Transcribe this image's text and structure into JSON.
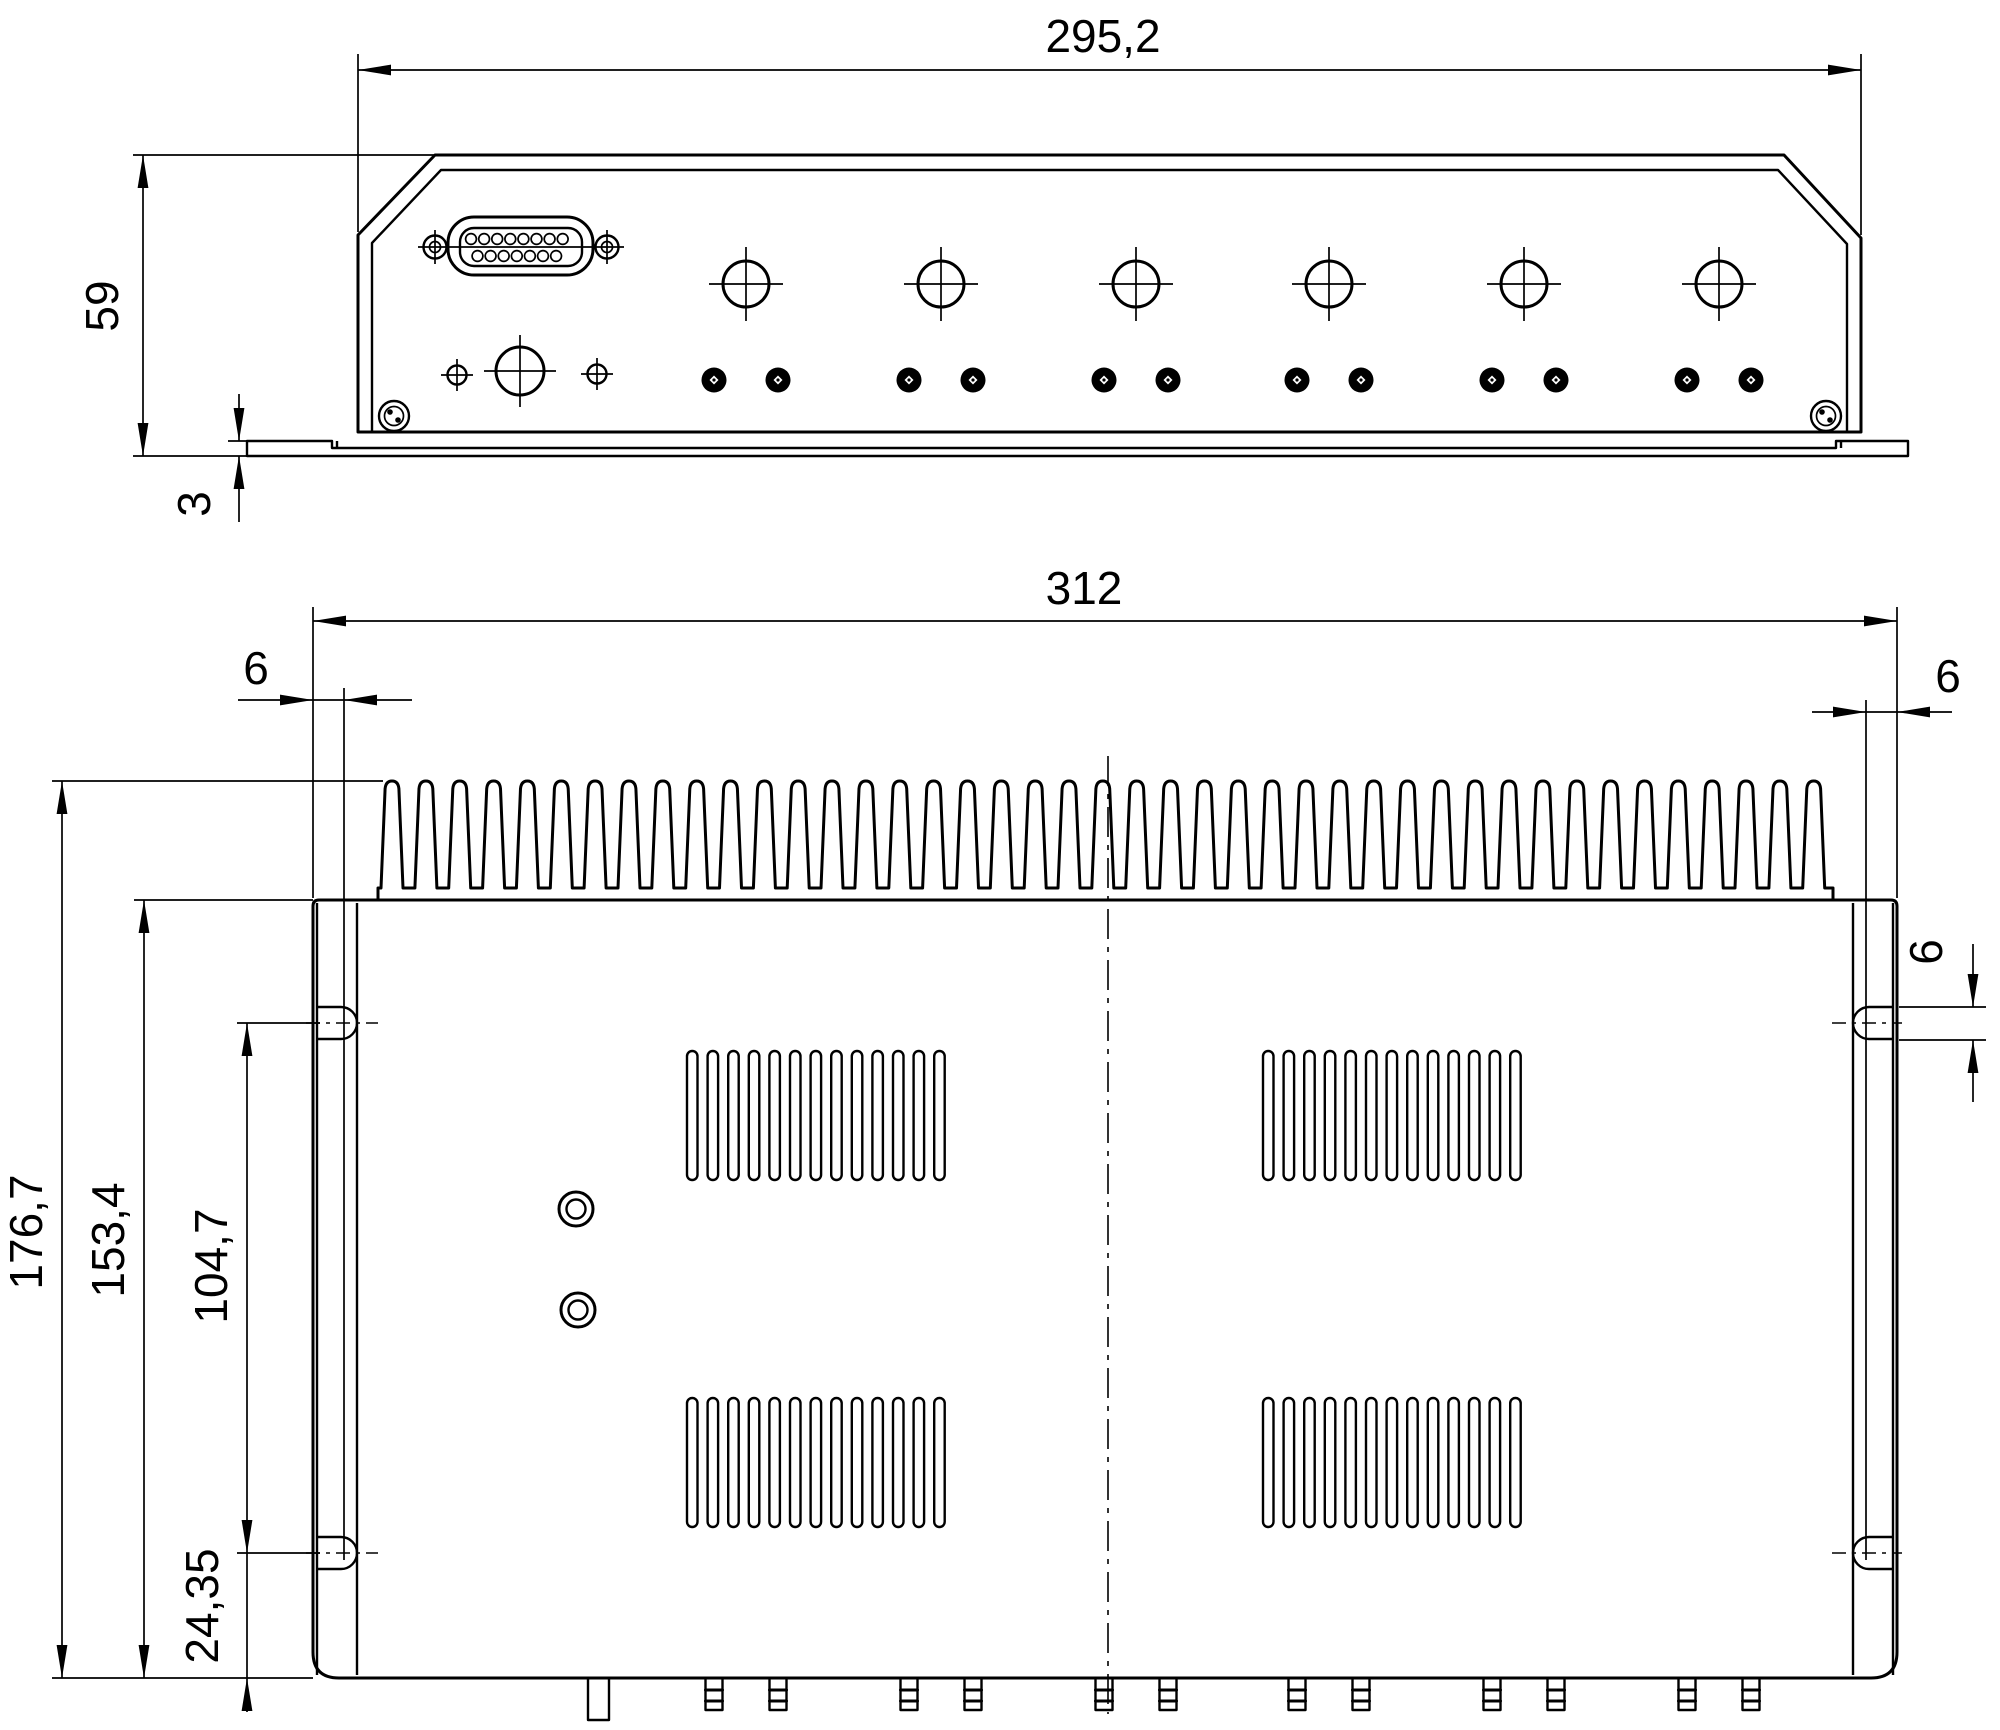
{
  "drawing": {
    "background_color": "#ffffff",
    "line_color": "#000000",
    "views": {
      "front_view": {
        "dimensions": {
          "overall_width": "295,2",
          "overall_height": "59",
          "flange_thickness": "3"
        }
      },
      "top_view": {
        "dimensions": {
          "overall_width": "312",
          "slot_offset_left": "6",
          "slot_offset_right": "6",
          "slot_hole_width": "6",
          "overall_depth": "176,7",
          "body_depth": "153,4",
          "mounting_hole_spacing": "104,7",
          "mounting_hole_offset_bottom": "24,35"
        }
      }
    }
  }
}
